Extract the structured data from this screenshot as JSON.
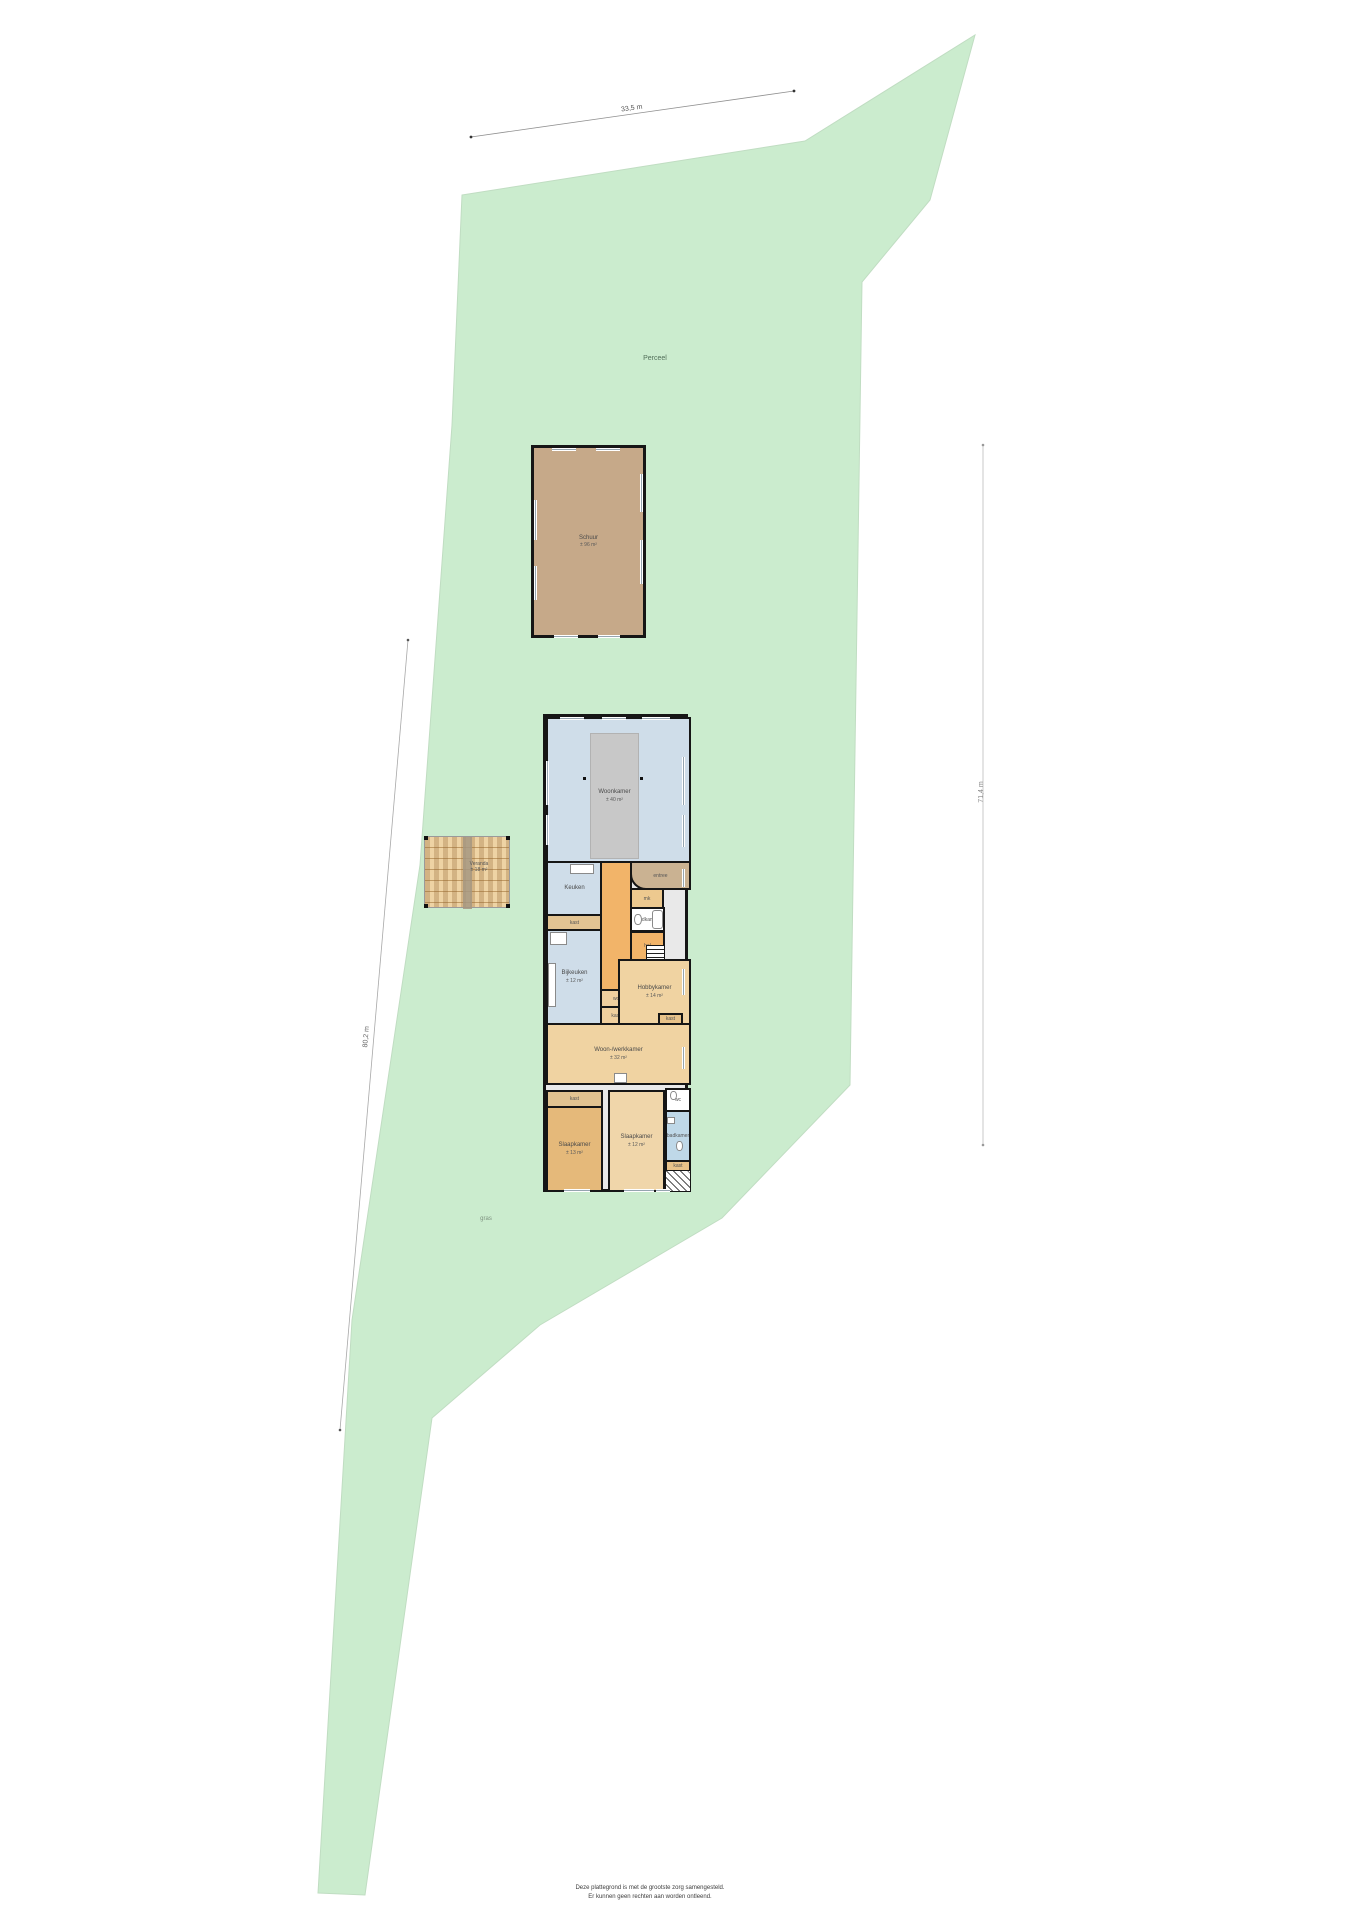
{
  "parcel": {
    "label": "Perceel",
    "surface_label": "gras"
  },
  "dimensions": {
    "top": "33,5 m",
    "left": "80,2 m",
    "right": "71,4 m"
  },
  "buildings": {
    "barn": {
      "name": "Schuur",
      "area": "± 96 m²"
    },
    "veranda": {
      "name": "Veranda",
      "area": "± 18 m²"
    }
  },
  "rooms": {
    "woonkamer": {
      "name": "Woonkamer",
      "area": "± 40 m²"
    },
    "keuken": {
      "name": "Keuken"
    },
    "bijkeuken": {
      "name": "Bijkeuken",
      "area": "± 12 m²"
    },
    "hal": {
      "name": "hal"
    },
    "entree": {
      "name": "entree"
    },
    "mk": {
      "name": "mk"
    },
    "badkamer": {
      "name": "badkamer"
    },
    "wc": {
      "name": "wc"
    },
    "kast": {
      "name": "kast"
    },
    "hobbykamer": {
      "name": "Hobbykamer",
      "area": "± 14 m²"
    },
    "woonwerkkamer": {
      "name": "Woon-/werkkamer",
      "area": "± 32 m²"
    },
    "slaapkamer1": {
      "name": "Slaapkamer",
      "area": "± 13 m²"
    },
    "slaapkamer2": {
      "name": "Slaapkamer",
      "area": "± 12 m²"
    }
  },
  "footer": {
    "line1": "Deze plattegrond is met de grootste zorg samengesteld.",
    "line2": "Er kunnen geen rechten aan worden ontleend."
  },
  "colors": {
    "green": "#cbecce",
    "barn": "#c6a989",
    "blue-room": "#cfdde9",
    "orange-hall": "#f2b469",
    "tan-room": "#f0d3a2",
    "deck": "#eed3a4",
    "bath-blue": "#bfd8e8"
  }
}
